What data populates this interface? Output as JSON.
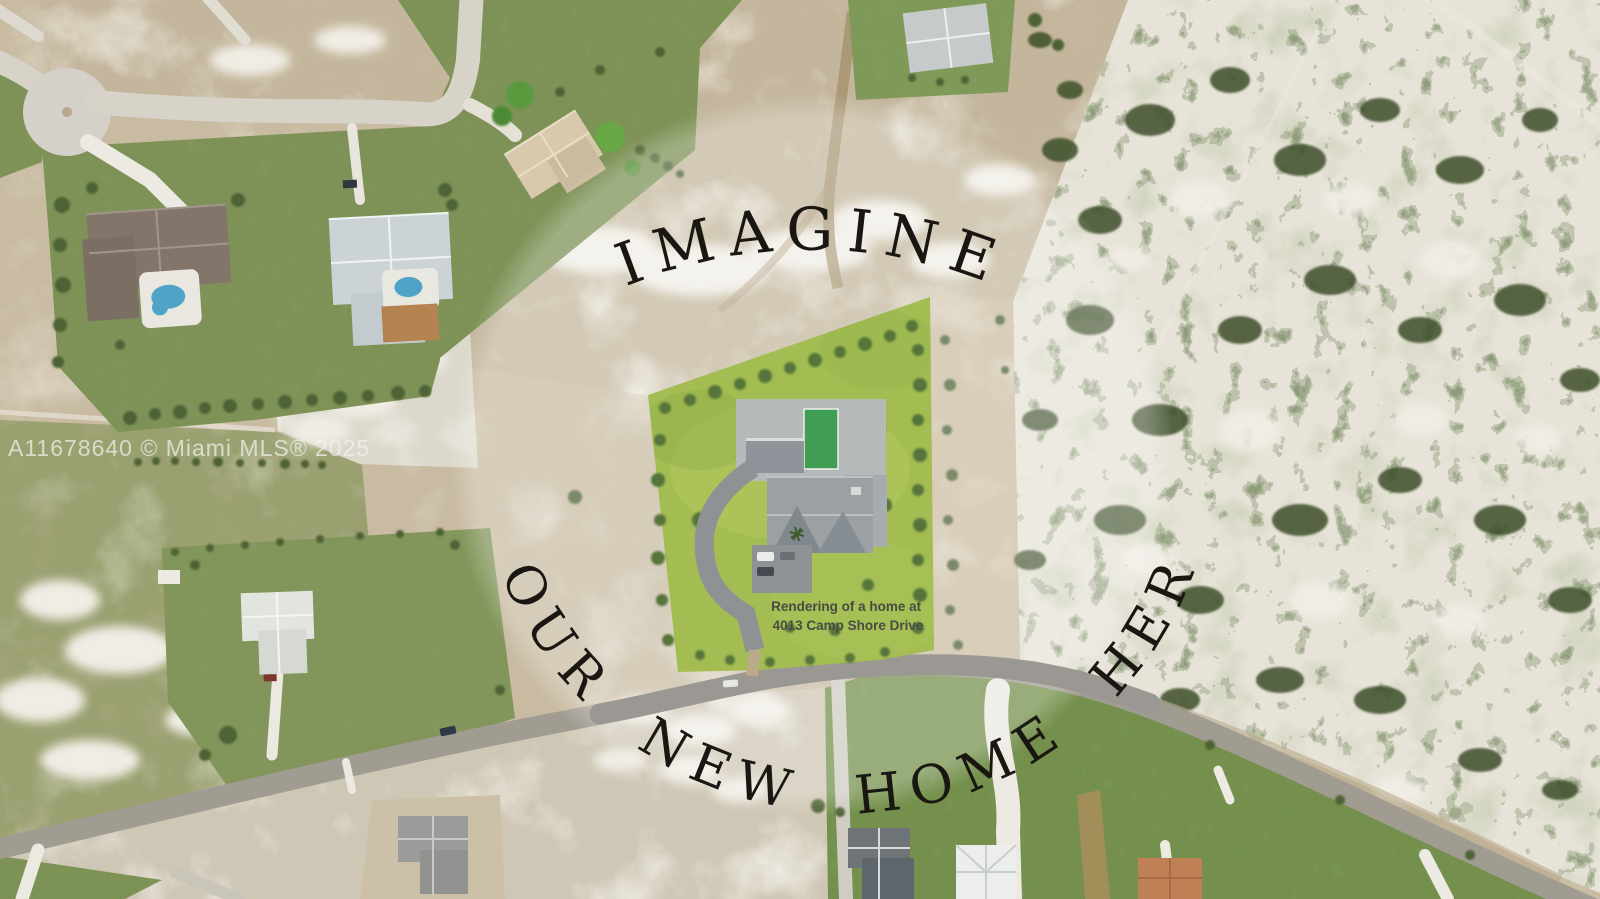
{
  "watermark": {
    "text": "A11678640 © Miami MLS® 2025"
  },
  "overlay": {
    "top_arc_text": "IMAGINE",
    "bottom_arc_text": "YOUR NEW HOME HERE"
  },
  "lot_label": {
    "line1": "Rendering of a home at",
    "line2": "4013 Camp Shore Drive"
  },
  "colors": {
    "dirt_base": "#c8bba2",
    "sand_white": "#ece9e0",
    "field_olive": "#9aa070",
    "lawn_green": "#7e9257",
    "lot_green": "#a3bd52",
    "pool_render_green": "#3f9e53",
    "pool_blue": "#4fa3c6",
    "scrub_sand": "#e7e3d8",
    "shrub_green": "#42522c",
    "road_gray": "#a19c92",
    "road_light": "#d7d3c9",
    "driveway_white": "#eceae2",
    "roof_gray": "#9aa0a4",
    "arc_text": "#1a1712",
    "watermark_text": "rgba(243,242,239,0.72)",
    "label_text": "#474c42",
    "overlay_tint": "rgba(255,255,255,0.26)"
  }
}
